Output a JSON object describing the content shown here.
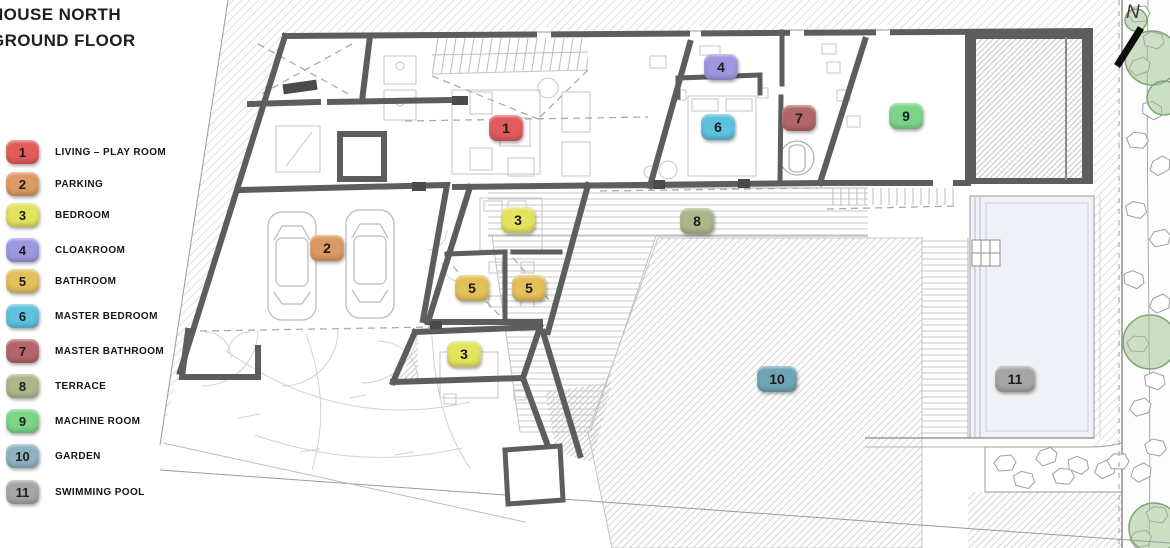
{
  "title": {
    "line1": "HOUSE NORTH",
    "line2": "GROUND FLOOR"
  },
  "legend": {
    "items": [
      {
        "number": "1",
        "label": "LIVING – PLAY ROOM",
        "color": "#e25b5b"
      },
      {
        "number": "2",
        "label": "PARKING",
        "color": "#db9a62"
      },
      {
        "number": "3",
        "label": "BEDROOM",
        "color": "#e3e45e"
      },
      {
        "number": "4",
        "label": "CLOAKROOM",
        "color": "#9d98e0"
      },
      {
        "number": "5",
        "label": "BATHROOM",
        "color": "#e4c05b"
      },
      {
        "number": "6",
        "label": "MASTER BEDROOM",
        "color": "#5ec1de"
      },
      {
        "number": "7",
        "label": "MASTER BATHROOM",
        "color": "#b2666a"
      },
      {
        "number": "8",
        "label": "TERRACE",
        "color": "#abb78a"
      },
      {
        "number": "9",
        "label": "MACHINE ROOM",
        "color": "#7cd489"
      },
      {
        "number": "10",
        "label": "GARDEN",
        "color": "#8fb2c1"
      },
      {
        "number": "11",
        "label": "SWIMMING POOL",
        "color": "#a6a6a6"
      }
    ]
  },
  "plan": {
    "north_label": "N",
    "badges": [
      {
        "number": "1",
        "room": "living-play-room",
        "color": "#e25b5b"
      },
      {
        "number": "2",
        "room": "parking",
        "color": "#db9a62"
      },
      {
        "number": "3",
        "room": "bedroom-upper",
        "color": "#e3e45e"
      },
      {
        "number": "3",
        "room": "bedroom-lower",
        "color": "#e3e45e"
      },
      {
        "number": "4",
        "room": "cloakroom",
        "color": "#9d98e0"
      },
      {
        "number": "5",
        "room": "bathroom-left",
        "color": "#e4c05b"
      },
      {
        "number": "5",
        "room": "bathroom-right",
        "color": "#e4c05b"
      },
      {
        "number": "6",
        "room": "master-bedroom",
        "color": "#5ec1de"
      },
      {
        "number": "7",
        "room": "master-bathroom",
        "color": "#b2666a"
      },
      {
        "number": "8",
        "room": "terrace",
        "color": "#abb78a"
      },
      {
        "number": "9",
        "room": "machine-room",
        "color": "#7cd489"
      },
      {
        "number": "10",
        "room": "garden",
        "color": "#6fa3b6"
      },
      {
        "number": "11",
        "room": "swimming-pool",
        "color": "#a6a6a6"
      }
    ]
  }
}
